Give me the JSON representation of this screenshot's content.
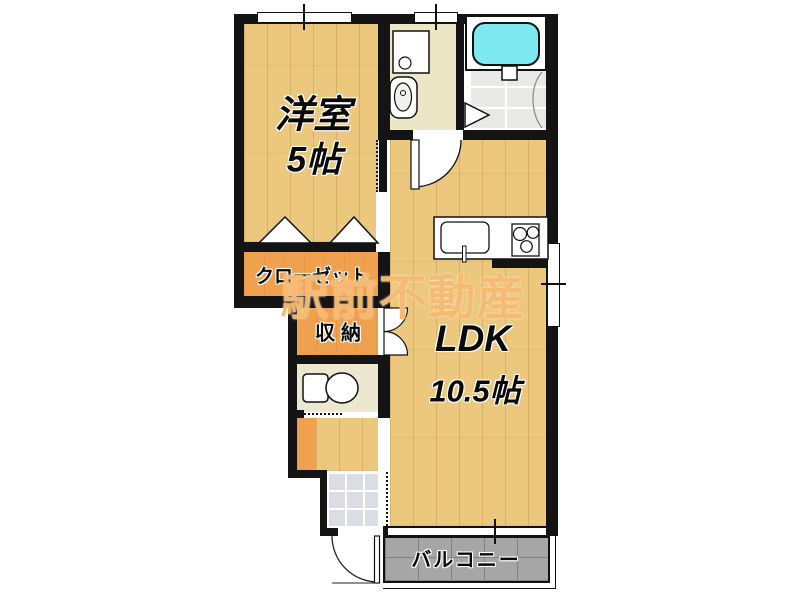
{
  "watermark_text": "駅前不動産",
  "rooms": {
    "western_room": {
      "label": "洋室",
      "size_label": "5帖"
    },
    "closet": {
      "label": "クローゼット"
    },
    "storage": {
      "label": "収納"
    },
    "ldk": {
      "label": "LDK",
      "size_label": "10.5帖"
    },
    "balcony": {
      "label": "バルコニー"
    }
  },
  "fixtures": {
    "bathtub": "bathtub",
    "bath_floor": "bathroom-floor",
    "washing_machine_pan": "washing-machine-pan",
    "wash_basin": "wash-basin",
    "toilet": "toilet",
    "kitchen_sink": "kitchen-sink",
    "stove": "three-burner-stove",
    "entrance": "genkan-tile",
    "entrance_door": "entrance-door",
    "closet_folding_doors": "folding-door-markers",
    "storage_double_doors": "double-swing-doors",
    "bath_folding_door": "folding-door-marker",
    "windows": "windows-with-center-ticks"
  },
  "colors": {
    "wall": "#141414",
    "wood_floor": "#ebc87e",
    "closet_orange": "#f0a14f",
    "bathtub_cyan": "#7fe9f2",
    "balcony_gray": "#a6a6a6",
    "washroom_cream": "#ede6c6",
    "watermark_orange": "#f5b66a"
  }
}
